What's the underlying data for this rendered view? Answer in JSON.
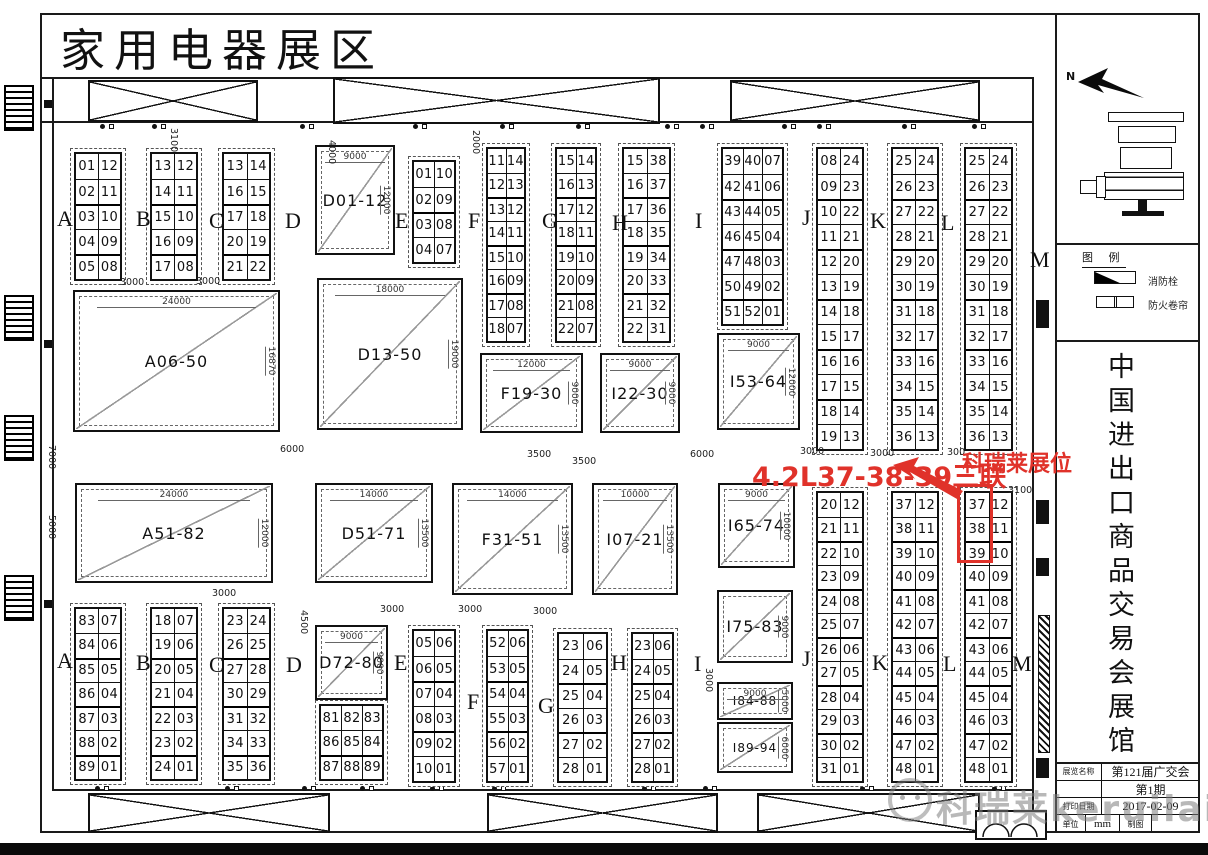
{
  "sheet": {
    "title": "家用电器展区"
  },
  "callouts": {
    "left_text": "4.2L37-38-39三联",
    "right_text": "科瑞莱展位",
    "highlight_color": "#e0322a",
    "highlighted_booths": [
      "37",
      "38",
      "39"
    ]
  },
  "letters": [
    "A",
    "B",
    "C",
    "D",
    "E",
    "F",
    "G",
    "H",
    "I",
    "J",
    "K",
    "L",
    "M"
  ],
  "columns": {
    "top-a": [
      [
        "01",
        "12"
      ],
      [
        "02",
        "11"
      ],
      [
        "03",
        "10"
      ],
      [
        "04",
        "09"
      ],
      [
        "05",
        "08"
      ]
    ],
    "top-b": [
      [
        "13",
        "12"
      ],
      [
        "14",
        "11"
      ],
      [
        "15",
        "10"
      ],
      [
        "16",
        "09"
      ],
      [
        "17",
        "08"
      ]
    ],
    "top-c": [
      [
        "13",
        "14"
      ],
      [
        "16",
        "15"
      ],
      [
        "17",
        "18"
      ],
      [
        "20",
        "19"
      ],
      [
        "21",
        "22"
      ]
    ],
    "top-e": [
      [
        "01",
        "10"
      ],
      [
        "02",
        "09"
      ],
      [
        "03",
        "08"
      ],
      [
        "04",
        "07"
      ]
    ],
    "top-f": [
      [
        "11",
        "14"
      ],
      [
        "12",
        "13"
      ],
      [
        "13",
        "12"
      ],
      [
        "14",
        "11"
      ],
      [
        "15",
        "10"
      ],
      [
        "16",
        "09"
      ],
      [
        "17",
        "08"
      ],
      [
        "18",
        "07"
      ]
    ],
    "top-g": [
      [
        "15",
        "14"
      ],
      [
        "16",
        "13"
      ],
      [
        "17",
        "12"
      ],
      [
        "18",
        "11"
      ],
      [
        "19",
        "10"
      ],
      [
        "20",
        "09"
      ],
      [
        "21",
        "08"
      ],
      [
        "22",
        "07"
      ]
    ],
    "top-h": [
      [
        "15",
        "38"
      ],
      [
        "16",
        "37"
      ],
      [
        "17",
        "36"
      ],
      [
        "18",
        "35"
      ],
      [
        "19",
        "34"
      ],
      [
        "20",
        "33"
      ],
      [
        "21",
        "32"
      ],
      [
        "22",
        "31"
      ]
    ],
    "top-i": [
      [
        "39",
        "40",
        "07"
      ],
      [
        "42",
        "41",
        "06"
      ],
      [
        "43",
        "44",
        "05"
      ],
      [
        "46",
        "45",
        "04"
      ],
      [
        "47",
        "48",
        "03"
      ],
      [
        "50",
        "49",
        "02"
      ],
      [
        "51",
        "52",
        "01"
      ]
    ],
    "top-j": [
      [
        "08",
        "24"
      ],
      [
        "09",
        "23"
      ],
      [
        "10",
        "22"
      ],
      [
        "11",
        "21"
      ],
      [
        "12",
        "20"
      ],
      [
        "13",
        "19"
      ],
      [
        "14",
        "18"
      ],
      [
        "15",
        "17"
      ],
      [
        "16",
        "16"
      ],
      [
        "17",
        "15"
      ],
      [
        "18",
        "14"
      ],
      [
        "19",
        "13"
      ]
    ],
    "top-k": [
      [
        "25",
        "24"
      ],
      [
        "26",
        "23"
      ],
      [
        "27",
        "22"
      ],
      [
        "28",
        "21"
      ],
      [
        "29",
        "20"
      ],
      [
        "30",
        "19"
      ],
      [
        "31",
        "18"
      ],
      [
        "32",
        "17"
      ],
      [
        "33",
        "16"
      ],
      [
        "34",
        "15"
      ],
      [
        "35",
        "14"
      ],
      [
        "36",
        "13"
      ]
    ],
    "top-l": [
      [
        "25",
        "24"
      ],
      [
        "26",
        "23"
      ],
      [
        "27",
        "22"
      ],
      [
        "28",
        "21"
      ],
      [
        "29",
        "20"
      ],
      [
        "30",
        "19"
      ],
      [
        "31",
        "18"
      ],
      [
        "32",
        "17"
      ],
      [
        "33",
        "16"
      ],
      [
        "34",
        "15"
      ],
      [
        "35",
        "14"
      ],
      [
        "36",
        "13"
      ]
    ],
    "low-j": [
      [
        "20",
        "12"
      ],
      [
        "21",
        "11"
      ],
      [
        "22",
        "10"
      ],
      [
        "23",
        "09"
      ],
      [
        "24",
        "08"
      ],
      [
        "25",
        "07"
      ],
      [
        "26",
        "06"
      ],
      [
        "27",
        "05"
      ],
      [
        "28",
        "04"
      ],
      [
        "29",
        "03"
      ],
      [
        "30",
        "02"
      ],
      [
        "31",
        "01"
      ]
    ],
    "low-k": [
      [
        "37",
        "12"
      ],
      [
        "38",
        "11"
      ],
      [
        "39",
        "10"
      ],
      [
        "40",
        "09"
      ],
      [
        "41",
        "08"
      ],
      [
        "42",
        "07"
      ],
      [
        "43",
        "06"
      ],
      [
        "44",
        "05"
      ],
      [
        "45",
        "04"
      ],
      [
        "46",
        "03"
      ],
      [
        "47",
        "02"
      ],
      [
        "48",
        "01"
      ]
    ],
    "low-l": [
      [
        "37",
        "12"
      ],
      [
        "38",
        "11"
      ],
      [
        "39",
        "10"
      ],
      [
        "40",
        "09"
      ],
      [
        "41",
        "08"
      ],
      [
        "42",
        "07"
      ],
      [
        "43",
        "06"
      ],
      [
        "44",
        "05"
      ],
      [
        "45",
        "04"
      ],
      [
        "46",
        "03"
      ],
      [
        "47",
        "02"
      ],
      [
        "48",
        "01"
      ]
    ],
    "bot-a": [
      [
        "83",
        "07"
      ],
      [
        "84",
        "06"
      ],
      [
        "85",
        "05"
      ],
      [
        "86",
        "04"
      ],
      [
        "87",
        "03"
      ],
      [
        "88",
        "02"
      ],
      [
        "89",
        "01"
      ]
    ],
    "bot-b": [
      [
        "18",
        "07"
      ],
      [
        "19",
        "06"
      ],
      [
        "20",
        "05"
      ],
      [
        "21",
        "04"
      ],
      [
        "22",
        "03"
      ],
      [
        "23",
        "02"
      ],
      [
        "24",
        "01"
      ]
    ],
    "bot-c": [
      [
        "23",
        "24"
      ],
      [
        "26",
        "25"
      ],
      [
        "27",
        "28"
      ],
      [
        "30",
        "29"
      ],
      [
        "31",
        "32"
      ],
      [
        "34",
        "33"
      ],
      [
        "35",
        "36"
      ]
    ],
    "bot-d": [
      [
        "81",
        "82",
        "83"
      ],
      [
        "86",
        "85",
        "84"
      ],
      [
        "87",
        "88",
        "89"
      ]
    ],
    "bot-e": [
      [
        "05",
        "06"
      ],
      [
        "06",
        "05"
      ],
      [
        "07",
        "04"
      ],
      [
        "08",
        "03"
      ],
      [
        "09",
        "02"
      ],
      [
        "10",
        "01"
      ]
    ],
    "bot-f": [
      [
        "52",
        "06"
      ],
      [
        "53",
        "05"
      ],
      [
        "54",
        "04"
      ],
      [
        "55",
        "03"
      ],
      [
        "56",
        "02"
      ],
      [
        "57",
        "01"
      ]
    ],
    "bot-g": [
      [
        "23",
        "06"
      ],
      [
        "24",
        "05"
      ],
      [
        "25",
        "04"
      ],
      [
        "26",
        "03"
      ],
      [
        "27",
        "02"
      ],
      [
        "28",
        "01"
      ]
    ],
    "bot-h": [
      [
        "23",
        "06"
      ],
      [
        "24",
        "05"
      ],
      [
        "25",
        "04"
      ],
      [
        "26",
        "03"
      ],
      [
        "27",
        "02"
      ],
      [
        "28",
        "01"
      ]
    ]
  },
  "blocks": {
    "d01": {
      "label": "D01-12",
      "dw": "9000",
      "dh": "12000"
    },
    "a06": {
      "label": "A06-50",
      "dw": "24000",
      "dh": "16870"
    },
    "d13": {
      "label": "D13-50",
      "dw": "18000",
      "dh": "19000"
    },
    "f19": {
      "label": "F19-30",
      "dw": "12000",
      "dh": "9000"
    },
    "i22": {
      "label": "I22-30",
      "dw": "9000",
      "dh": "9000"
    },
    "i53": {
      "label": "I53-64",
      "dw": "9000",
      "dh": "12000"
    },
    "a51": {
      "label": "A51-82",
      "dw": "24000",
      "dh": "12000"
    },
    "d51": {
      "label": "D51-71",
      "dw": "14000",
      "dh": "13500"
    },
    "f31": {
      "label": "F31-51",
      "dw": "14000",
      "dh": "13500"
    },
    "i07": {
      "label": "I07-21",
      "dw": "10000",
      "dh": "13500"
    },
    "i65": {
      "label": "I65-74",
      "dw": "9000",
      "dh": "10000"
    },
    "i75": {
      "label": "I75-83",
      "dw": "",
      "dh": "9000"
    },
    "i84": {
      "label": "I84-88",
      "dw": "9000",
      "dh": "5000"
    },
    "i89": {
      "label": "I89-94",
      "dw": "",
      "dh": "6000"
    },
    "d72": {
      "label": "D72-80",
      "dw": "9000",
      "dh": "9000"
    }
  },
  "dims": [
    "7000",
    "6000",
    "3500",
    "3500",
    "6000",
    "3000",
    "3000",
    "300",
    "3100",
    "5000",
    "3000",
    "4500",
    "3000",
    "3000",
    "3000",
    "3100",
    "4000",
    "2000",
    "3000",
    "3000",
    "3000"
  ],
  "sidebar": {
    "north_label": "N",
    "legend_title": "图 例",
    "legend_items": [
      {
        "name": "fire-hydrant",
        "label": "消防栓"
      },
      {
        "name": "fire-shutter",
        "label": "防火卷帘"
      }
    ],
    "hall_name": "中国进出口商品交易会展馆",
    "title_block": {
      "rows": [
        {
          "label": "展览名称",
          "value": "第121届广交会"
        },
        {
          "label": "",
          "value": "第1期"
        },
        {
          "label": "打印日期",
          "value": "2017-02-09"
        }
      ],
      "unit_label": "单位",
      "unit_value": "mm",
      "draw_label": "制图",
      "draw_value": ""
    }
  },
  "watermark": {
    "text": "科瑞莱keruilai"
  }
}
